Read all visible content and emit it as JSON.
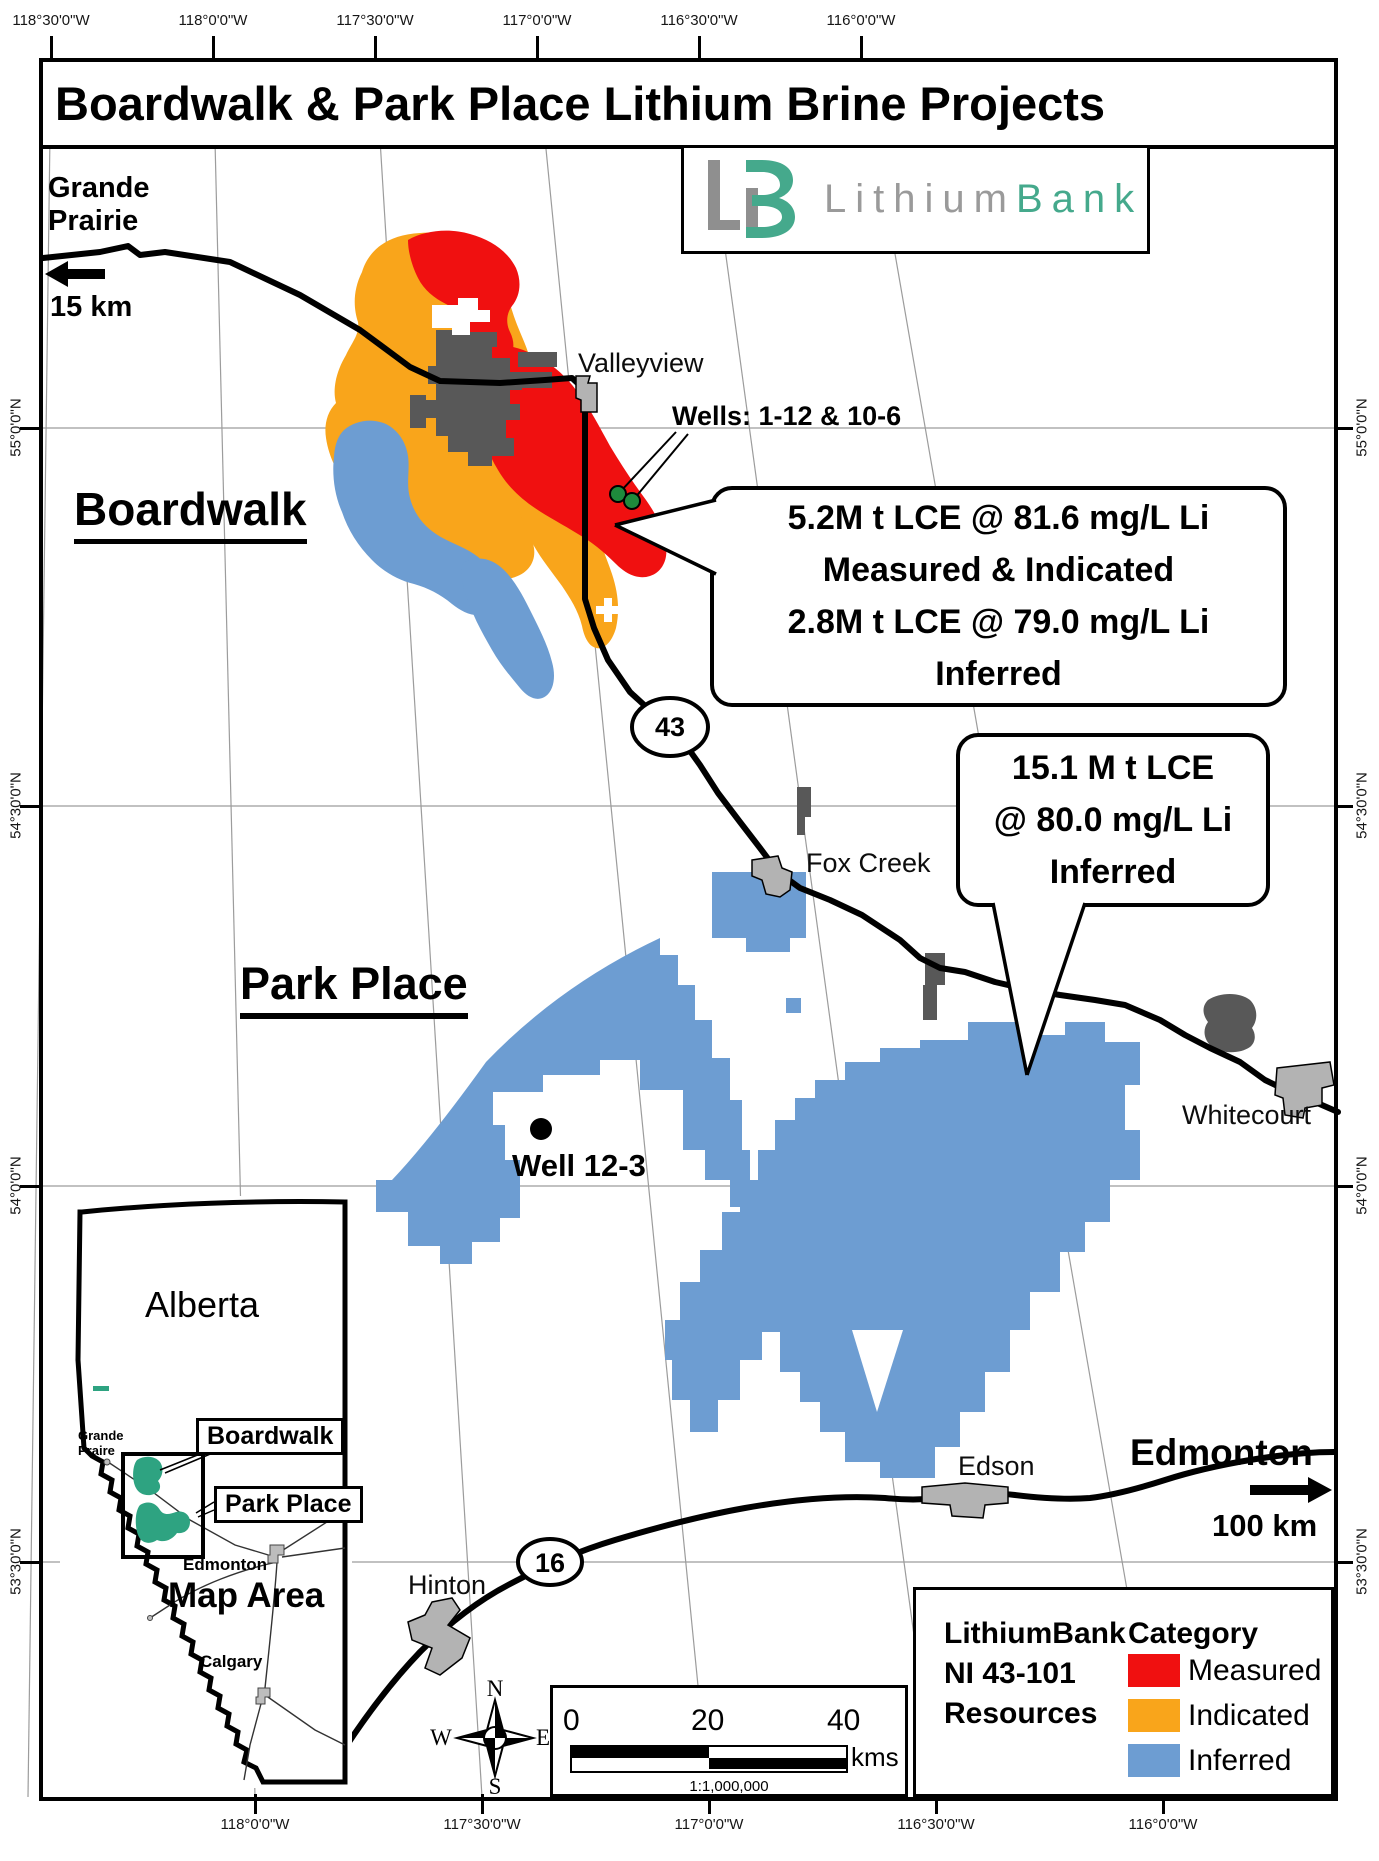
{
  "title": "Boardwalk & Park Place Lithium Brine Projects",
  "logo": {
    "word1": "Lithium",
    "word2": "Bank"
  },
  "graticule": {
    "top": [
      "118°30'0\"W",
      "118°0'0\"W",
      "117°30'0\"W",
      "117°0'0\"W",
      "116°30'0\"W",
      "116°0'0\"W"
    ],
    "bottom": [
      "118°0'0\"W",
      "117°30'0\"W",
      "117°0'0\"W",
      "116°30'0\"W",
      "116°0'0\"W"
    ],
    "left": [
      "55°0'0\"N",
      "54°30'0\"N",
      "54°0'0\"N",
      "53°30'0\"N"
    ],
    "right": [
      "55°0'0\"N",
      "54°30'0\"N",
      "54°0'0\"N",
      "53°30'0\"N"
    ]
  },
  "map_labels": {
    "grande_prairie_line1": "Grande",
    "grande_prairie_line2": "Prairie",
    "grande_prairie_dist": "15 km",
    "boardwalk": "Boardwalk",
    "valleyview": "Valleyview",
    "wells": "Wells: 1-12 & 10-6",
    "hwy43": "43",
    "hwy16": "16",
    "fox_creek": "Fox Creek",
    "park_place": "Park Place",
    "well_12_3": "Well 12-3",
    "whitecourt": "Whitecourt",
    "edson": "Edson",
    "edmonton": "Edmonton",
    "edmonton_dist": "100 km",
    "hinton": "Hinton"
  },
  "callout_boardwalk": {
    "line1": "5.2M t LCE @ 81.6 mg/L Li",
    "line2": "Measured & Indicated",
    "line3": "2.8M t LCE @ 79.0 mg/L Li",
    "line4": "Inferred"
  },
  "callout_park_place": {
    "line1": "15.1 M t LCE",
    "line2": "@ 80.0 mg/L Li",
    "line3": "Inferred"
  },
  "inset": {
    "province": "Alberta",
    "grande_prairie_line1": "Grande",
    "grande_prairie_line2": "Praire",
    "boardwalk": "Boardwalk",
    "park_place": "Park Place",
    "edmonton": "Edmonton",
    "map_area": "Map Area",
    "calgary": "Calgary"
  },
  "legend": {
    "title_line1": "LithiumBank",
    "title_line2": "NI 43-101",
    "title_line3": "Resources",
    "category": "Category",
    "items": [
      {
        "label": "Measured",
        "color": "#F01010"
      },
      {
        "label": "Indicated",
        "color": "#F9A51B"
      },
      {
        "label": "Inferred",
        "color": "#6D9DD2"
      }
    ]
  },
  "scalebar": {
    "t0": "0",
    "t20": "20",
    "t40": "40",
    "unit": "kms",
    "ratio": "1:1,000,000"
  },
  "compass": {
    "n": "N",
    "e": "E",
    "s": "S",
    "w": "W"
  },
  "colors": {
    "measured_red": "#F01010",
    "indicated_orange": "#F9A51B",
    "inferred_blue": "#6D9DD2",
    "project_green": "#2EA381",
    "town_gray": "#B3B3B3",
    "urban_dark_gray": "#585858",
    "logo_gray": "#9a9a9a",
    "logo_green": "#45a98c"
  }
}
